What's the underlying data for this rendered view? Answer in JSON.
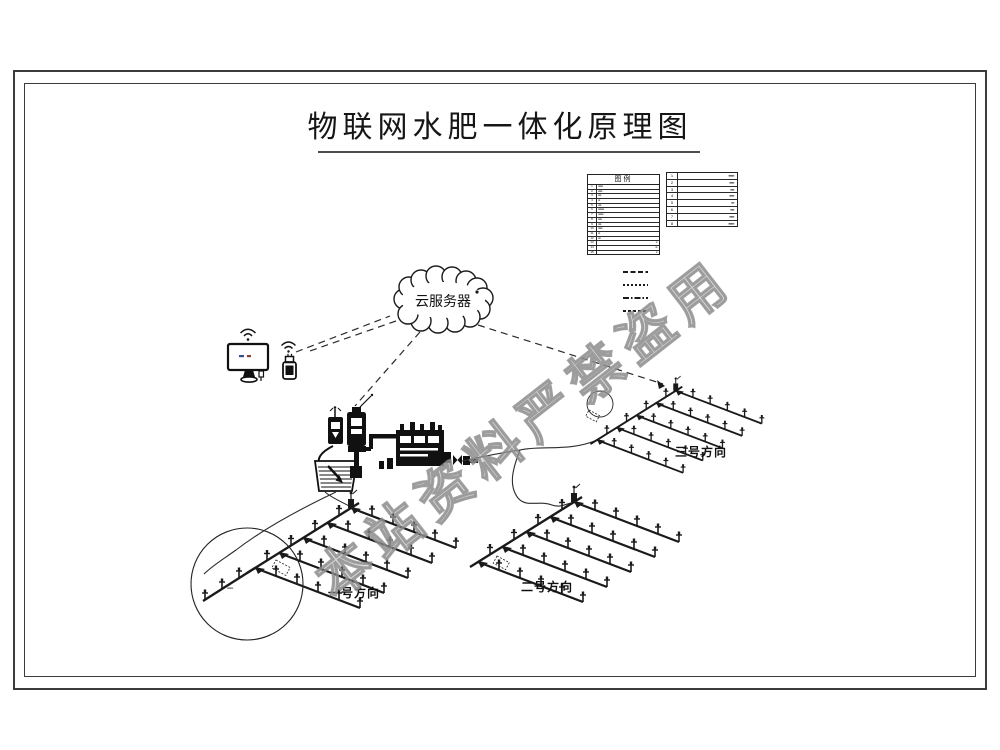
{
  "sheet": {
    "title": "物联网水肥一体化原理图"
  },
  "legend": {
    "header": "图例",
    "table1_rows": [
      {
        "num": "1",
        "text": "▪▪▪▪▪▪▪▪"
      },
      {
        "num": "2",
        "text": "▪▪▪▪▪▪▪"
      },
      {
        "num": "3",
        "text": "▪▪▪▪▪"
      },
      {
        "num": "4",
        "text": "▪▪▪"
      },
      {
        "num": "5",
        "text": "▪▪▪▪▪"
      },
      {
        "num": "6",
        "text": "▪▪▪▪▪▪▪▪▪▪"
      },
      {
        "num": "7",
        "text": "▪▪▪▪▪▪▪▪▪"
      },
      {
        "num": "8",
        "text": "▪▪▪▪▪▪"
      },
      {
        "num": "9",
        "text": "▪▪▪▪▪"
      },
      {
        "num": "10",
        "text": "▪▪▪▪▪▪▪"
      },
      {
        "num": "11",
        "text": "▪▪▪"
      },
      {
        "num": "12",
        "text": "▪▪▪▪"
      },
      {
        "num": "13",
        "text": "▪▪"
      },
      {
        "num": "14",
        "text": "▪▪▪"
      },
      {
        "num": "15",
        "text": "▪▪"
      }
    ],
    "table2_rows": [
      {
        "num": "1",
        "text": "▪▪▪▪▪▪"
      },
      {
        "num": "2",
        "text": "▪▪▪▪▪"
      },
      {
        "num": "3",
        "text": "▪▪▪▪"
      },
      {
        "num": "4",
        "text": "▪▪▪▪▪"
      },
      {
        "num": "5",
        "text": "▪▪▪"
      },
      {
        "num": "6",
        "text": "▪▪▪▪"
      },
      {
        "num": "7",
        "text": "▪▪▪▪▪"
      },
      {
        "num": "8",
        "text": "▪▪▪▪▪▪"
      }
    ]
  },
  "cloud": {
    "label": "云服务器"
  },
  "fields": {
    "direction1": "一号方向",
    "direction2": "二号方向",
    "direction3": "三号方向"
  },
  "callout": {
    "note": "▪▪▪▪▪▪▪▪▪▪"
  },
  "watermark": {
    "text": "本站资料严禁盗用",
    "color": "#9e9e9e"
  },
  "accent_colors": {
    "ink": "#1a1a1a",
    "frame": "#3c3c3c"
  }
}
